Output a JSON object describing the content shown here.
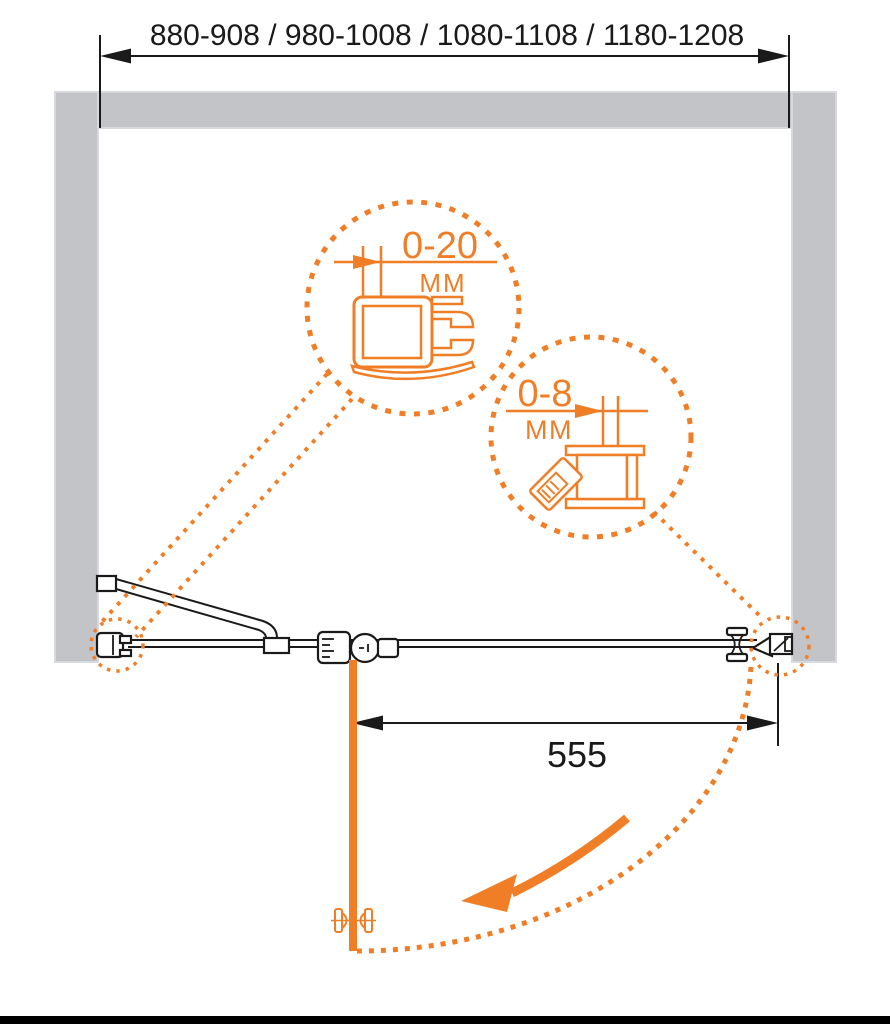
{
  "diagram": {
    "title": "shower-door-installation-plan",
    "top_dimension": {
      "label": "880-908 / 980-1008 / 1080-1108 / 1180-1208"
    },
    "door_dimension": {
      "label": "555"
    },
    "detail_callouts": [
      {
        "id": "wall-profile-adjustment",
        "value": "0-20",
        "unit": "MM"
      },
      {
        "id": "door-profile-adjustment",
        "value": "0-8",
        "unit": "MM"
      }
    ]
  },
  "icons": {
    "dimension_arrow": "filled-triangle-arrowhead",
    "swing_direction_arrow": "curved-arrow-down-left",
    "detail_magnifier": "dotted-circle-callout"
  },
  "colors": {
    "accent_orange": "#F07E26",
    "wall_gray": "#C2C4C8",
    "wall_gray_edge": "#D7D9DC",
    "line_black": "#1A1A1A",
    "background": "#FFFFFF",
    "footer_bar": "#000000"
  }
}
